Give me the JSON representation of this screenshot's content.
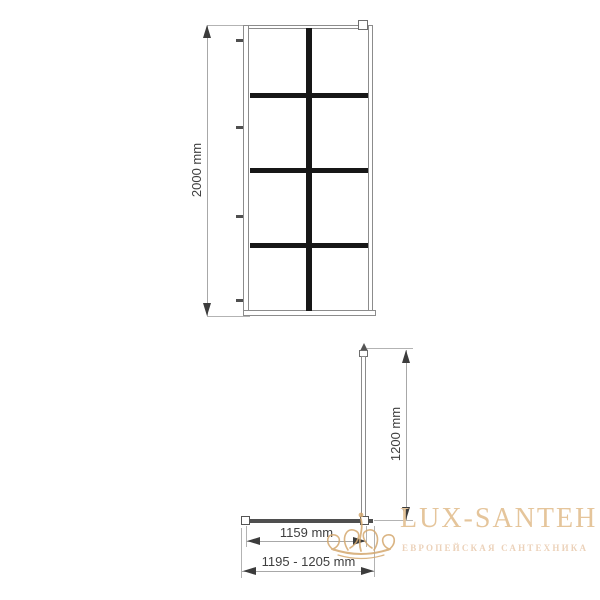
{
  "front_view": {
    "description": "front elevation of walk-in shower screen with 2x4 black grid",
    "height_label": "2000 mm",
    "grid": {
      "columns": 2,
      "rows": 4
    },
    "mullion_color": "#171717",
    "outline_color": "#8c8c8c"
  },
  "plan_view": {
    "description": "top plan view with wall support bar",
    "support_bar_label": "1200 mm",
    "glass_width_label": "1159 mm",
    "adjustment_range_label": "1195 - 1205 mm"
  },
  "dimension_style": {
    "text_color": "#3f3f3f",
    "line_color": "#a8a8a8",
    "arrow_color": "#3c3c3c"
  },
  "watermark": {
    "brand": "LUX-SANTEH",
    "tagline": "ЕВРОПЕЙСКАЯ САНТЕХНИКА",
    "brand_color": "#e5c59b",
    "tagline_color": "#ecd2ba",
    "icon": "crown-flourish-icon",
    "icon_color": "#d4a86e"
  }
}
